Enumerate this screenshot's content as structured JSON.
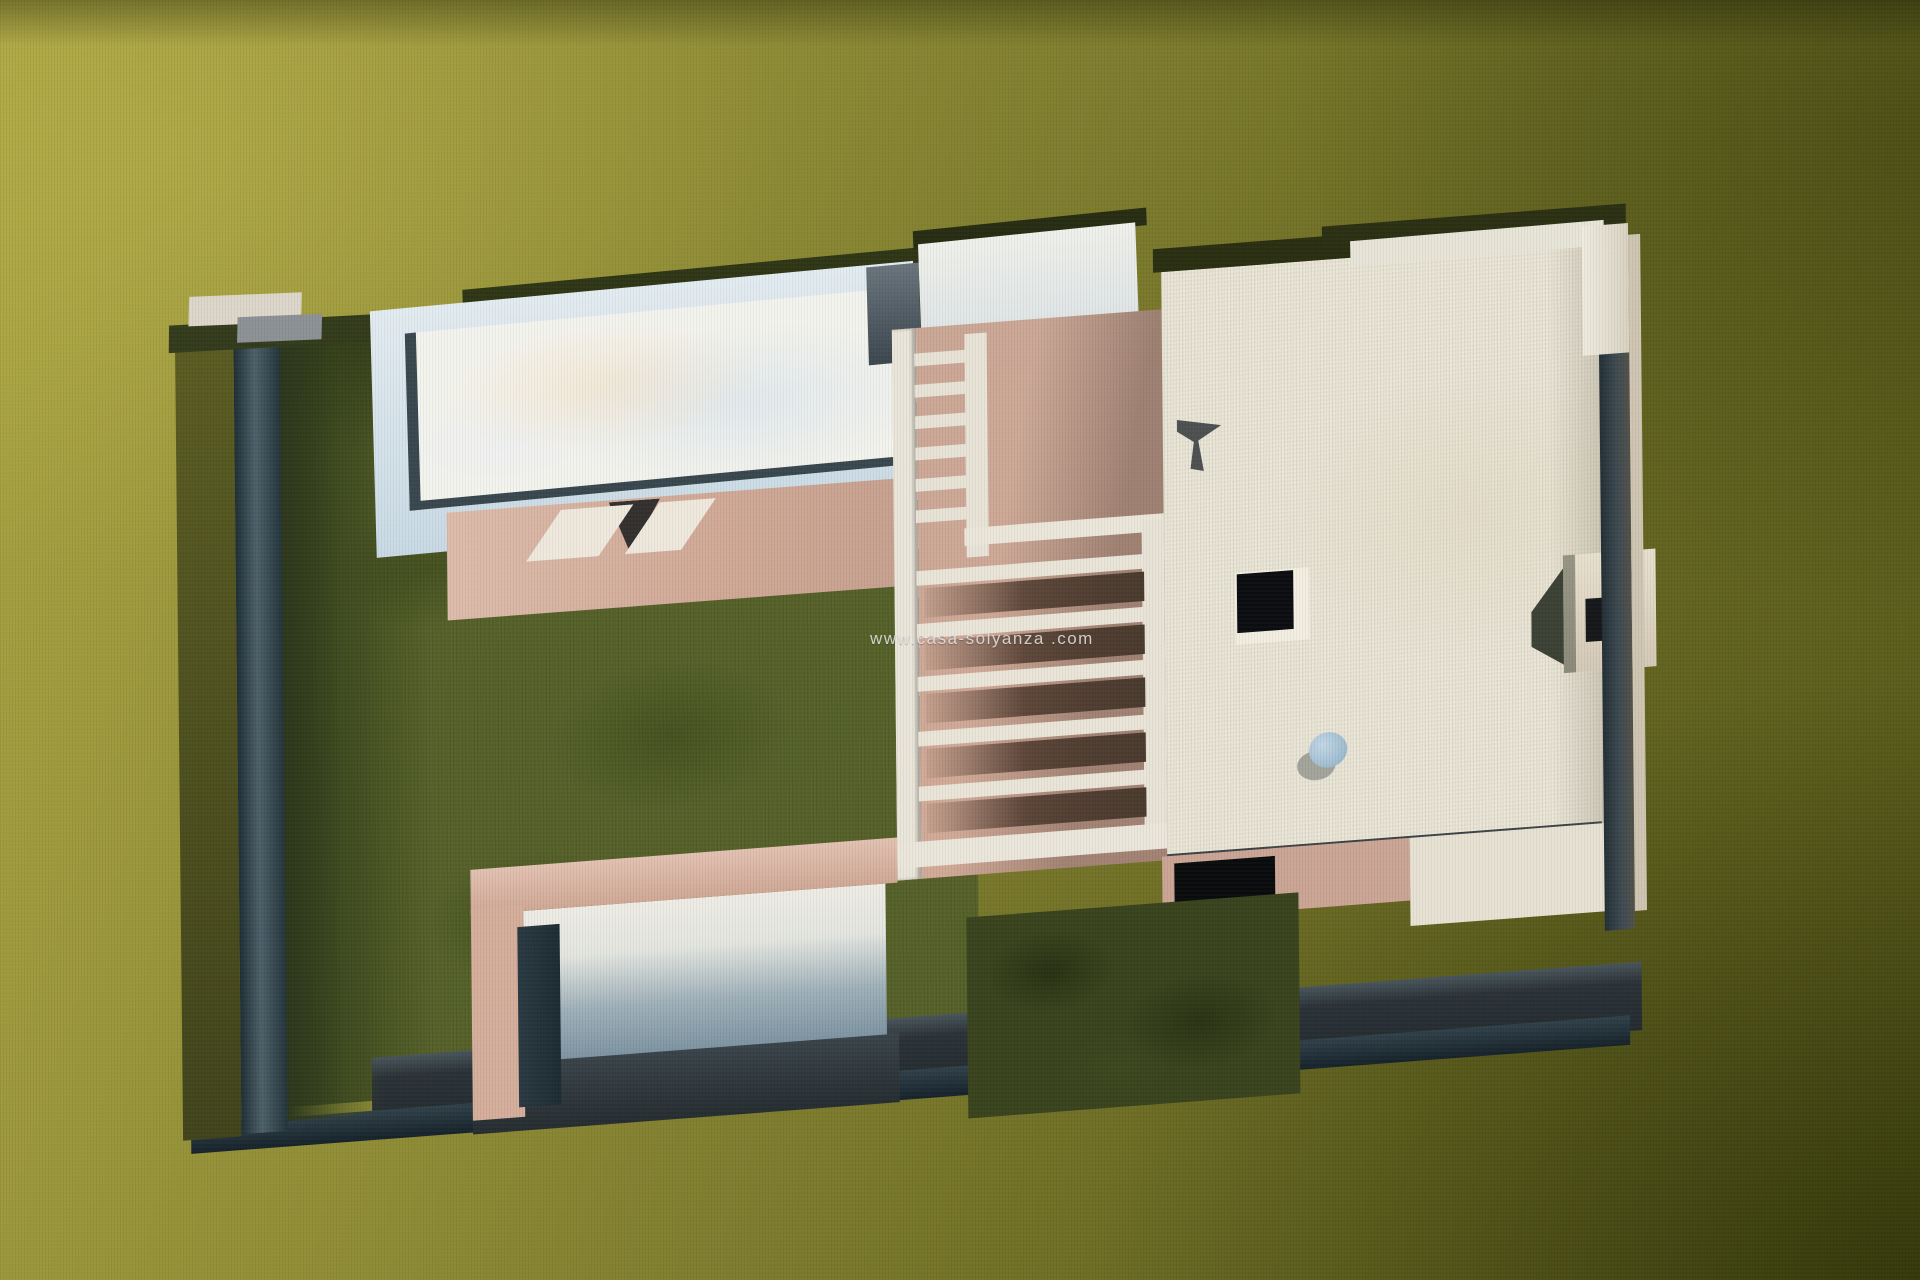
{
  "watermark": {
    "text": "www.casa-solyanza .com",
    "color": "#e4e4e4"
  },
  "palette": {
    "bg-light": "#a9a441",
    "bg-mid": "#8e8b35",
    "bg-dark": "#6c6c24",
    "bg-deep": "#555818",
    "lawn": "#57632a",
    "hedge": "#39431d",
    "wall-slate": "#2b3a41",
    "wall-slate-light": "#4d6069",
    "pool-deck": "#c9dae5",
    "pool-water": "#f4f4ee",
    "terrace-pink": "#d2aa98",
    "terrace-pink-light": "#ddbcab",
    "slat-cream": "#ebe6da",
    "roof-cream": "#ece8da",
    "shadow-brown": "#4a3a2e",
    "garage-blue": "#7e95a2",
    "window-black": "#0b0d10",
    "dome-blue": "#8fb0c6",
    "watermark-gray": "#e0e0e0"
  },
  "icons": {
    "skylight": "roof-skylight-square",
    "dome": "roof-chimney-dome"
  }
}
